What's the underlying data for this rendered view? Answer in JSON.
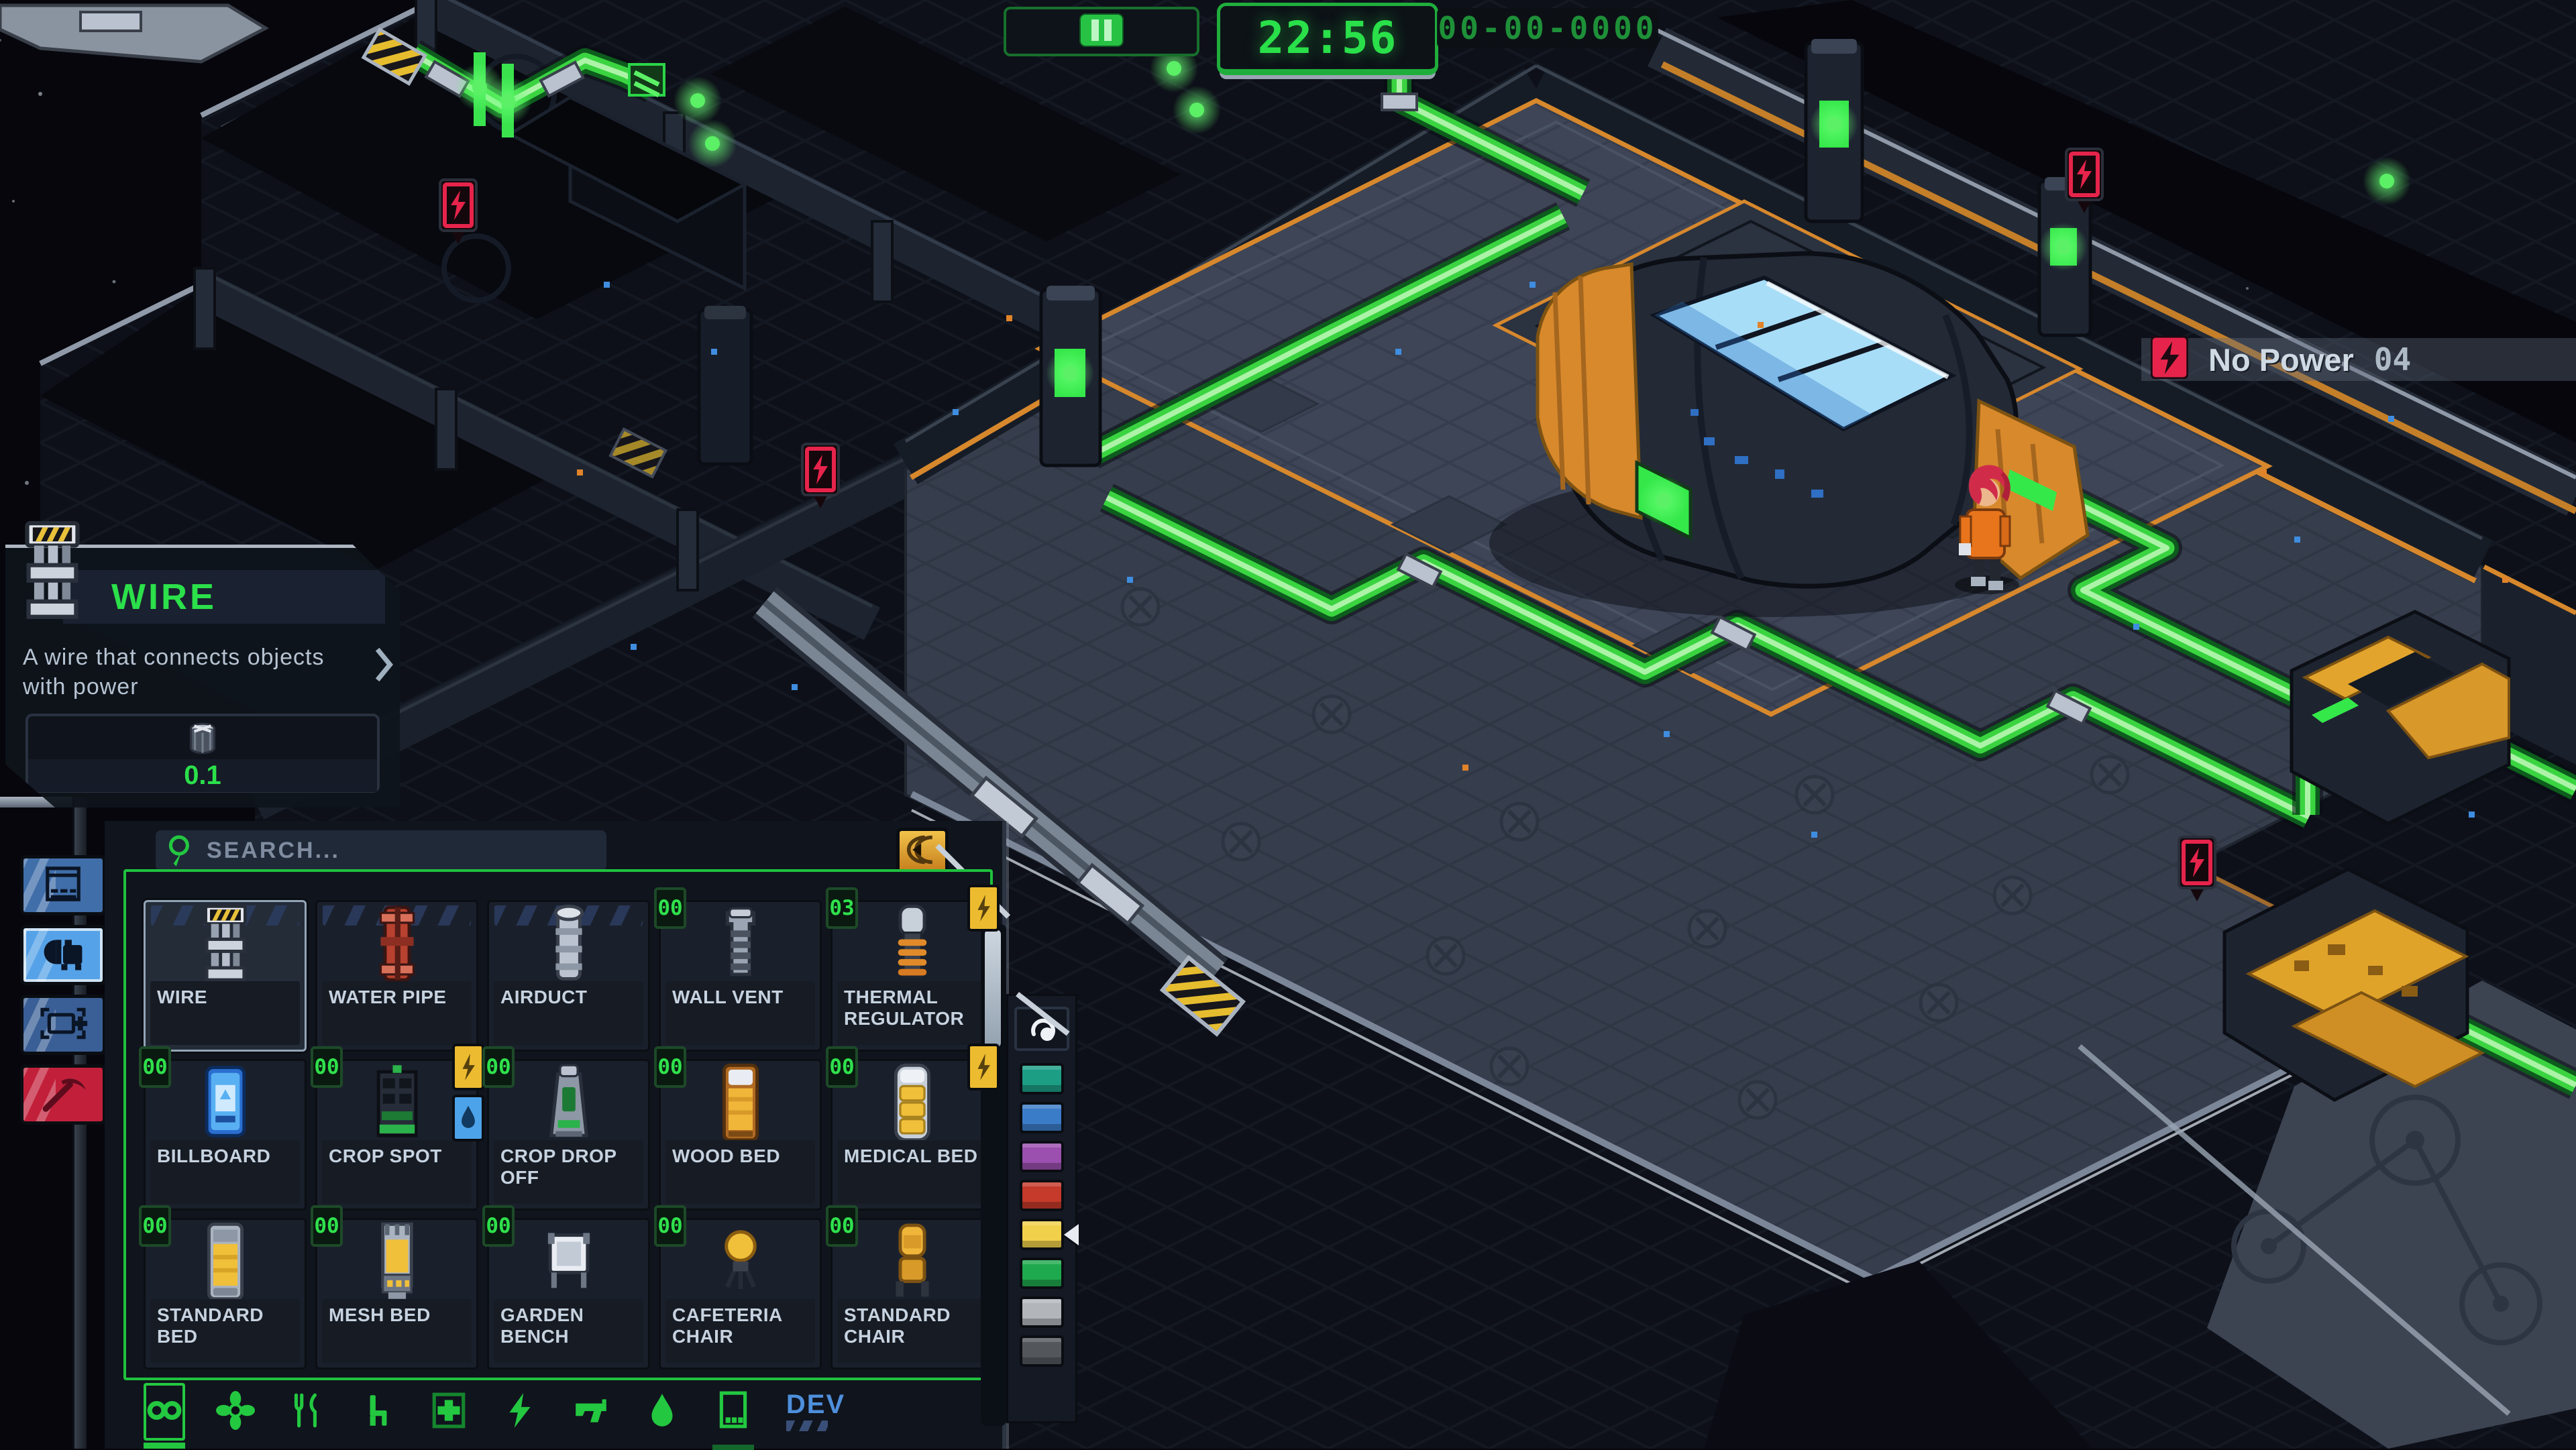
{
  "top_bar": {
    "pause_icon": "pause-icon",
    "time": "22:56",
    "date": "00-00-0000"
  },
  "alert_banner": {
    "icon": "no-power-icon",
    "label": "No Power",
    "count": "04"
  },
  "tooltip": {
    "icon": "wire",
    "title": "WIRE",
    "description": "A wire that connects objects with power",
    "cost_icon": "metal-icon",
    "cost": "0.1"
  },
  "sidebar": [
    {
      "id": "hull",
      "icon": "hull-panel",
      "style": "blue",
      "selected": false
    },
    {
      "id": "objects",
      "icon": "machine",
      "style": "bright",
      "selected": true
    },
    {
      "id": "zones",
      "icon": "zone-frame-plus",
      "style": "dark",
      "selected": false
    },
    {
      "id": "demolish",
      "icon": "pickaxe",
      "style": "red",
      "selected": false
    }
  ],
  "build_menu": {
    "search_placeholder": "SEARCH...",
    "collapse_button_icon": "collapse-arrow",
    "items": [
      {
        "name": "WIRE",
        "icon": "wire",
        "selected": true,
        "wall_stripes": true
      },
      {
        "name": "WATER PIPE",
        "icon": "water-pipe",
        "wall_stripes": true
      },
      {
        "name": "AIRDUCT",
        "icon": "airduct",
        "wall_stripes": true
      },
      {
        "name": "WALL VENT",
        "icon": "wall-vent",
        "count": "00"
      },
      {
        "name": "THERMAL REGULATOR",
        "icon": "thermal-regulator",
        "count": "03",
        "power": true
      },
      {
        "name": "BILLBOARD",
        "icon": "billboard",
        "count": "00"
      },
      {
        "name": "CROP SPOT",
        "icon": "crop-spot",
        "count": "00",
        "power": true,
        "water": true
      },
      {
        "name": "CROP DROP OFF",
        "icon": "crop-dropoff",
        "count": "00"
      },
      {
        "name": "WOOD BED",
        "icon": "wood-bed",
        "count": "00"
      },
      {
        "name": "MEDICAL BED",
        "icon": "medical-bed",
        "count": "00",
        "power": true
      },
      {
        "name": "STANDARD BED",
        "icon": "standard-bed",
        "count": "00"
      },
      {
        "name": "MESH BED",
        "icon": "mesh-bed",
        "count": "00"
      },
      {
        "name": "GARDEN BENCH",
        "icon": "garden-bench",
        "count": "00"
      },
      {
        "name": "CAFETERIA CHAIR",
        "icon": "cafeteria-chair",
        "count": "00"
      },
      {
        "name": "STANDARD CHAIR",
        "icon": "standard-chair",
        "count": "00"
      }
    ],
    "tabs": [
      {
        "id": "all",
        "icon": "infinity",
        "selected": true
      },
      {
        "id": "life-support",
        "icon": "fan"
      },
      {
        "id": "food",
        "icon": "utensils"
      },
      {
        "id": "furniture",
        "icon": "chair"
      },
      {
        "id": "medical",
        "icon": "medkit"
      },
      {
        "id": "power",
        "icon": "lightning"
      },
      {
        "id": "security",
        "icon": "gun"
      },
      {
        "id": "water",
        "icon": "droplet"
      },
      {
        "id": "storage",
        "icon": "storage-box",
        "indicator": true
      },
      {
        "id": "dev",
        "icon": "dev",
        "label": "DEV"
      }
    ]
  },
  "palette": {
    "icon": "paint-swirl",
    "swatches": [
      {
        "name": "teal",
        "hex": "#1c9e85"
      },
      {
        "name": "blue",
        "hex": "#3b7cc9"
      },
      {
        "name": "purple",
        "hex": "#9b4fae"
      },
      {
        "name": "red",
        "hex": "#c53a2a"
      },
      {
        "name": "yellow",
        "hex": "#f1d04b",
        "selected": true
      },
      {
        "name": "green",
        "hex": "#1fa94e"
      },
      {
        "name": "light-gray",
        "hex": "#b2b6bb"
      },
      {
        "name": "dark-gray",
        "hex": "#53575c"
      }
    ]
  },
  "scene": {
    "no_power_markers": 4,
    "character": {
      "name": "crew-member",
      "suit_color": "#e8751c",
      "hair_color": "#d02c4a"
    },
    "generator": {
      "glass_color": "#a8ddf8",
      "armor_color": "#d8892c",
      "screen_color": "#35e84a"
    },
    "wire_color": "#3bd441",
    "floor_trim_color": "#d7882c",
    "alert_color": "#e6244b",
    "accent_green": "#23c840"
  }
}
